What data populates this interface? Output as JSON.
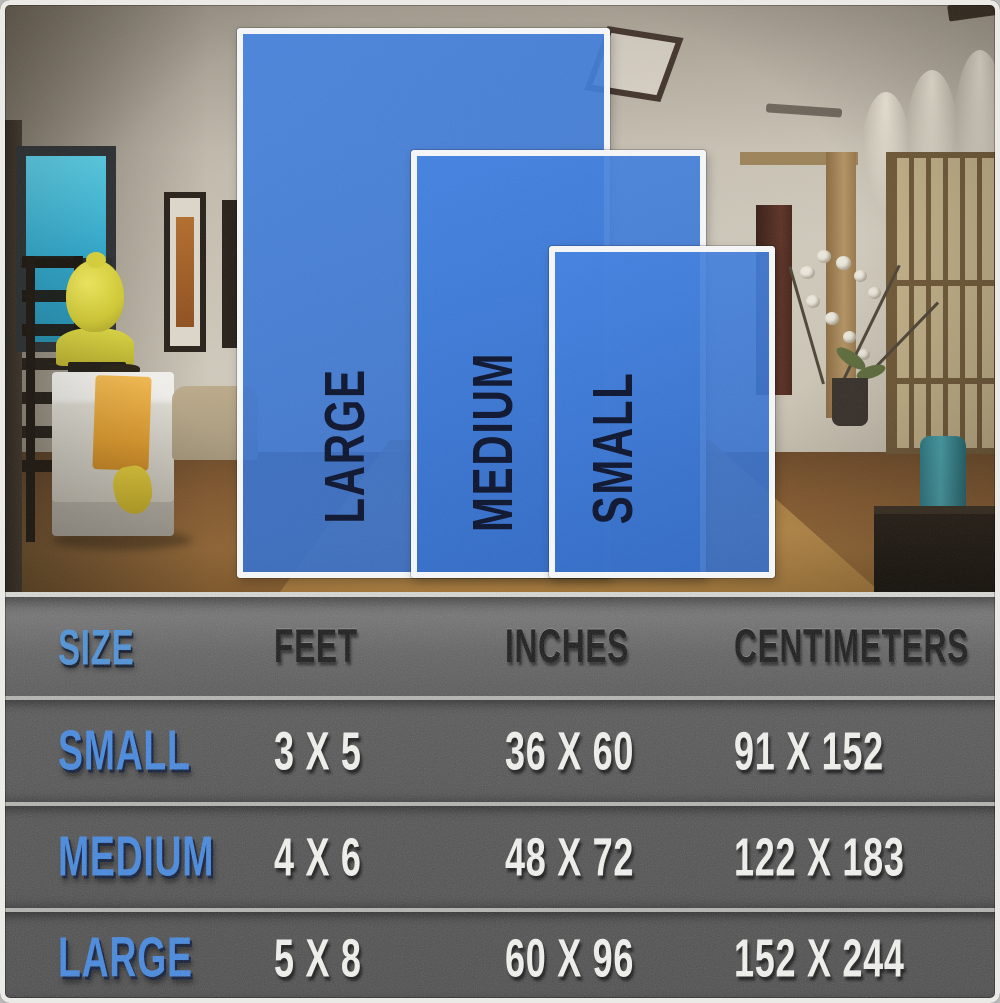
{
  "overlay": {
    "rugs": [
      {
        "label": "LARGE"
      },
      {
        "label": "MEDIUM"
      },
      {
        "label": "SMALL"
      }
    ]
  },
  "table": {
    "columns": [
      "SIZE",
      "FEET",
      "INCHES",
      "CENTIMETERS"
    ],
    "rows": [
      {
        "cells": [
          "SMALL",
          "3 X 5",
          "36 X 60",
          "91 X 152"
        ]
      },
      {
        "cells": [
          "MEDIUM",
          "4 X 6",
          "48 X 72",
          "122 X 183"
        ]
      },
      {
        "cells": [
          "LARGE",
          "5 X 8",
          "60 X 96",
          "152 X 244"
        ]
      }
    ]
  },
  "chart_data": {
    "type": "table",
    "title": "Rug size comparison chart",
    "columns": [
      "SIZE",
      "FEET",
      "INCHES",
      "CENTIMETERS"
    ],
    "rows": [
      [
        "SMALL",
        "3 X 5",
        "36 X 60",
        "91 X 152"
      ],
      [
        "MEDIUM",
        "4 X 6",
        "48 X 72",
        "122 X 183"
      ],
      [
        "LARGE",
        "5 X 8",
        "60 X 96",
        "152 X 244"
      ]
    ],
    "overlay_sizes_front_to_back": [
      "SMALL",
      "MEDIUM",
      "LARGE"
    ]
  },
  "colors": {
    "rug_blue": "#3c7ad4",
    "rug_label_navy": "#0b132e",
    "accent_blue": "#4a90d9",
    "value_white": "#f4f4f1",
    "table_gray": "#515151"
  }
}
